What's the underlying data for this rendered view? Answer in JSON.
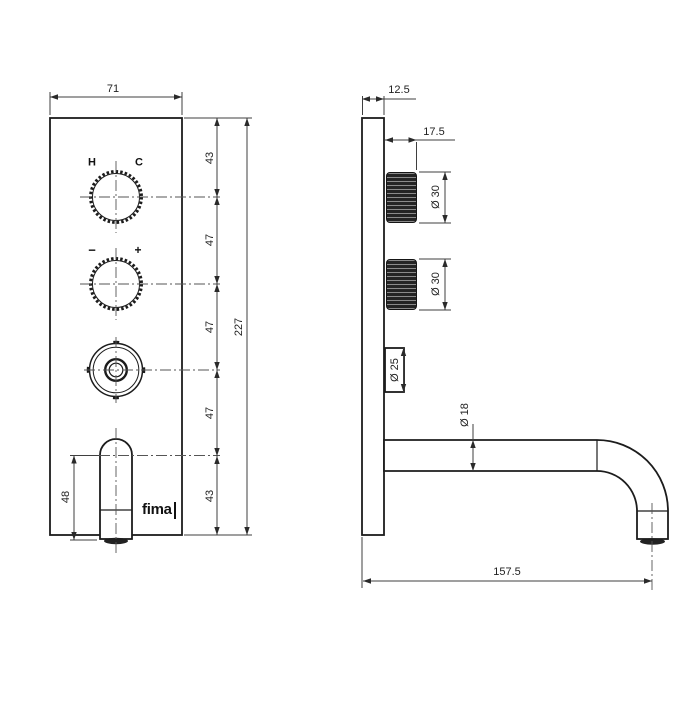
{
  "drawing": {
    "brand_logo": "fima",
    "colors": {
      "background": "#ffffff",
      "object_line": "#1c1c1c",
      "dimension_line": "#3f3f3f"
    },
    "front_view": {
      "handle_top_labels": {
        "hot": "H",
        "cold": "C"
      },
      "handle_mid_labels": {
        "minus": "−",
        "plus": "+"
      },
      "width_dim": "71",
      "overall_height_dim": "227",
      "height_segments": [
        "43",
        "47",
        "47",
        "47",
        "43"
      ],
      "spout_drop_dim": "48"
    },
    "side_view": {
      "plate_thickness_dim": "12.5",
      "handle_projection_dim": "17.5",
      "handle_top_diameter": "Ø 30",
      "handle_mid_diameter": "Ø 30",
      "diverter_diameter": "Ø 25",
      "spout_diameter": "Ø 18",
      "spout_reach_dim": "157.5"
    }
  }
}
